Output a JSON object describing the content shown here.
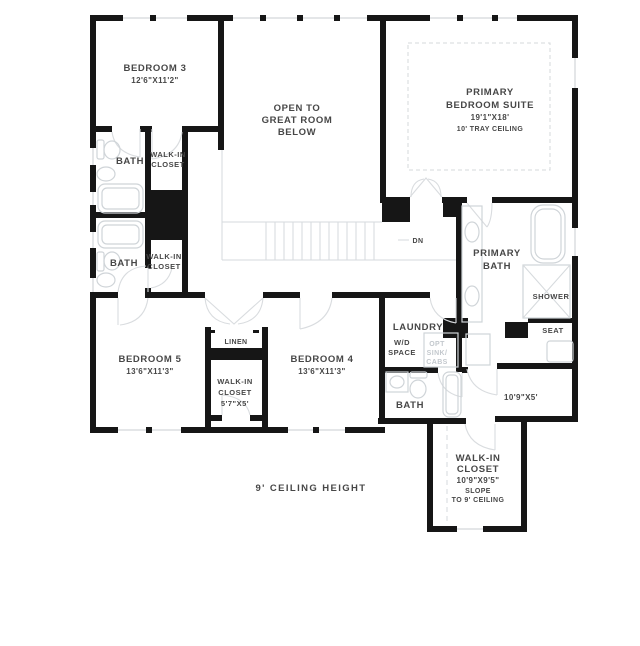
{
  "floorplan": {
    "title": "Second floor residential plan",
    "rooms": {
      "bedroom3": {
        "name": "BEDROOM 3",
        "dims": "12'6\"X11'2\""
      },
      "open_below": {
        "line1": "OPEN TO",
        "line2": "GREAT ROOM",
        "line3": "BELOW"
      },
      "primary_suite": {
        "line1": "PRIMARY",
        "line2": "BEDROOM SUITE",
        "dims": "19'1\"X18'",
        "ceiling": "10' TRAY CEILING"
      },
      "bath_upper": {
        "name": "BATH"
      },
      "closet_upper": {
        "line1": "WALK-IN",
        "line2": "CLOSET"
      },
      "bath_mid": {
        "name": "BATH"
      },
      "closet_mid": {
        "line1": "WALK-IN",
        "line2": "CLOSET"
      },
      "primary_bath": {
        "line1": "PRIMARY",
        "line2": "BATH"
      },
      "shower": {
        "name": "SHOWER"
      },
      "seat": {
        "name": "SEAT"
      },
      "bedroom5": {
        "name": "BEDROOM 5",
        "dims": "13'6\"X11'3\""
      },
      "linen": {
        "name": "LINEN"
      },
      "closet_hall": {
        "line1": "WALK-IN",
        "line2": "CLOSET",
        "dims": "5'7\"X5'"
      },
      "bedroom4": {
        "name": "BEDROOM 4",
        "dims": "13'6\"X11'3\""
      },
      "laundry": {
        "name": "LAUNDRY",
        "wd1": "W/D",
        "wd2": "SPACE",
        "opt1": "OPT",
        "opt2": "SINK/",
        "opt3": "CABS"
      },
      "bath_lower": {
        "name": "BATH"
      },
      "hall": {
        "dims": "10'9\"X5'"
      },
      "closet_primary": {
        "line1": "WALK-IN",
        "line2": "CLOSET",
        "dims": "10'9\"X9'5\"",
        "note1": "SLOPE",
        "note2": "TO 9' CEILING"
      }
    },
    "annotations": {
      "stair_direction": "DN",
      "ceiling_note": "9' CEILING HEIGHT"
    },
    "colors": {
      "wall": "#161616",
      "fixture_line": "#cfd4d8",
      "text": "#474747",
      "muted_text": "#c3c8cd",
      "background": "#ffffff"
    }
  }
}
